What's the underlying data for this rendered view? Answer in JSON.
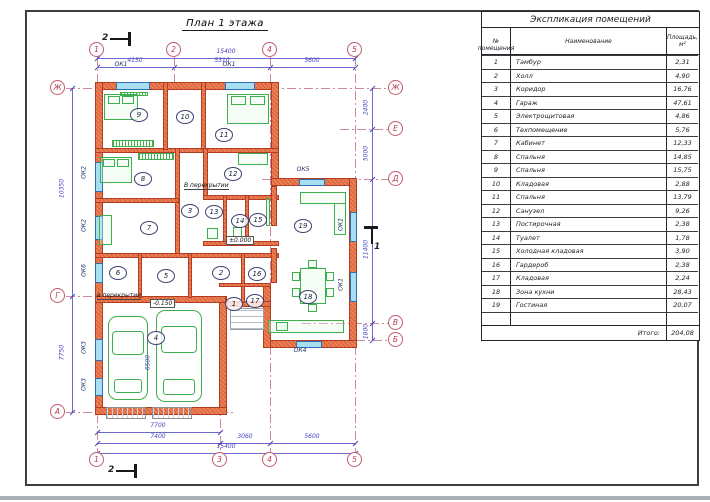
{
  "sheet": {
    "title": "План 1 этажа"
  },
  "table": {
    "title": "Экспликация помещений",
    "col_num": "№ помещения",
    "col_name": "Наименование",
    "col_area_1": "Площадь,",
    "col_area_2": "м²",
    "rows": [
      {
        "n": "1",
        "name": "Тамбур",
        "area": "2,31"
      },
      {
        "n": "2",
        "name": "Холл",
        "area": "4,90"
      },
      {
        "n": "3",
        "name": "Коридор",
        "area": "16,76"
      },
      {
        "n": "4",
        "name": "Гараж",
        "area": "47,61"
      },
      {
        "n": "5",
        "name": "Электрощитовая",
        "area": "4,86"
      },
      {
        "n": "6",
        "name": "Техпомещение",
        "area": "5,76"
      },
      {
        "n": "7",
        "name": "Кабинет",
        "area": "12,33"
      },
      {
        "n": "8",
        "name": "Спальня",
        "area": "14,85"
      },
      {
        "n": "9",
        "name": "Спальня",
        "area": "15,75"
      },
      {
        "n": "10",
        "name": "Кладовая",
        "area": "2,88"
      },
      {
        "n": "11",
        "name": "Спальня",
        "area": "13,79"
      },
      {
        "n": "12",
        "name": "Санузел",
        "area": "9,26"
      },
      {
        "n": "13",
        "name": "Постирочная",
        "area": "2,38"
      },
      {
        "n": "14",
        "name": "Туалет",
        "area": "1,78"
      },
      {
        "n": "15",
        "name": "Холодная кладовая",
        "area": "3,90"
      },
      {
        "n": "16",
        "name": "Гардероб",
        "area": "2,38"
      },
      {
        "n": "17",
        "name": "Кладовая",
        "area": "2,24"
      },
      {
        "n": "18",
        "name": "Зона кухни",
        "area": "28,43"
      },
      {
        "n": "19",
        "name": "Гостиная",
        "area": "20,07"
      }
    ],
    "total_label": "Итого:",
    "total_value": "204,08"
  },
  "plan": {
    "colors": {
      "wall": "#ee7f52",
      "wall_edge": "#b23c24",
      "win": "#a8dff0",
      "win_edge": "#2f6fb5",
      "furn": "#3fae4e",
      "dim": "#4a43c0",
      "grid": "#c4738c",
      "bub": "#c25a70"
    },
    "walls_ext": [
      {
        "x": 95,
        "y": 82,
        "w": 184,
        "h": 8
      },
      {
        "x": 95,
        "y": 82,
        "w": 8,
        "h": 333
      },
      {
        "x": 271,
        "y": 82,
        "w": 8,
        "h": 104
      },
      {
        "x": 271,
        "y": 178,
        "w": 86,
        "h": 8
      },
      {
        "x": 349,
        "y": 178,
        "w": 8,
        "h": 170
      },
      {
        "x": 263,
        "y": 340,
        "w": 94,
        "h": 8
      },
      {
        "x": 263,
        "y": 283,
        "w": 8,
        "h": 65
      },
      {
        "x": 227,
        "y": 301,
        "w": 44,
        "h": 6
      },
      {
        "x": 219,
        "y": 296,
        "w": 8,
        "h": 119
      },
      {
        "x": 95,
        "y": 296,
        "w": 131,
        "h": 7
      },
      {
        "x": 95,
        "y": 407,
        "w": 132,
        "h": 8
      }
    ],
    "walls_int": [
      {
        "x": 95,
        "y": 148,
        "w": 184,
        "h": 5
      },
      {
        "x": 163,
        "y": 82,
        "w": 5,
        "h": 68
      },
      {
        "x": 201,
        "y": 82,
        "w": 5,
        "h": 68
      },
      {
        "x": 175,
        "y": 148,
        "w": 5,
        "h": 110
      },
      {
        "x": 203,
        "y": 148,
        "w": 5,
        "h": 52
      },
      {
        "x": 203,
        "y": 195,
        "w": 76,
        "h": 5
      },
      {
        "x": 223,
        "y": 195,
        "w": 4,
        "h": 50
      },
      {
        "x": 245,
        "y": 195,
        "w": 4,
        "h": 50
      },
      {
        "x": 95,
        "y": 198,
        "w": 84,
        "h": 5
      },
      {
        "x": 203,
        "y": 241,
        "w": 76,
        "h": 5
      },
      {
        "x": 95,
        "y": 253,
        "w": 184,
        "h": 5
      },
      {
        "x": 138,
        "y": 253,
        "w": 4,
        "h": 45
      },
      {
        "x": 188,
        "y": 253,
        "w": 4,
        "h": 45
      },
      {
        "x": 241,
        "y": 253,
        "w": 4,
        "h": 50
      },
      {
        "x": 219,
        "y": 283,
        "w": 52,
        "h": 4
      },
      {
        "x": 271,
        "y": 186,
        "w": 6,
        "h": 40
      },
      {
        "x": 271,
        "y": 248,
        "w": 6,
        "h": 35
      }
    ],
    "windows": [
      {
        "x": 116,
        "y": 82,
        "w": 34,
        "h": 8
      },
      {
        "x": 225,
        "y": 82,
        "w": 30,
        "h": 8
      },
      {
        "x": 95,
        "y": 162,
        "w": 8,
        "h": 30
      },
      {
        "x": 95,
        "y": 216,
        "w": 8,
        "h": 24
      },
      {
        "x": 95,
        "y": 263,
        "w": 8,
        "h": 20
      },
      {
        "x": 95,
        "y": 339,
        "w": 8,
        "h": 22
      },
      {
        "x": 95,
        "y": 378,
        "w": 8,
        "h": 18
      },
      {
        "x": 350,
        "y": 212,
        "w": 7,
        "h": 30
      },
      {
        "x": 350,
        "y": 272,
        "w": 7,
        "h": 30
      },
      {
        "x": 299,
        "y": 179,
        "w": 26,
        "h": 7
      },
      {
        "x": 296,
        "y": 341,
        "w": 26,
        "h": 7
      }
    ],
    "window_labels": [
      {
        "t": "ОК1",
        "x": 121,
        "y": 64
      },
      {
        "t": "ОК1",
        "x": 229,
        "y": 64
      },
      {
        "t": "ОК5",
        "x": 303,
        "y": 169
      },
      {
        "t": "ОК4",
        "x": 300,
        "y": 350
      },
      {
        "t": "ОК2",
        "x": 84,
        "y": 172,
        "rot": true
      },
      {
        "t": "ОК2",
        "x": 84,
        "y": 225,
        "rot": true
      },
      {
        "t": "ОК6",
        "x": 84,
        "y": 270,
        "rot": true
      },
      {
        "t": "ОК3",
        "x": 84,
        "y": 347,
        "rot": true
      },
      {
        "t": "ОК3",
        "x": 84,
        "y": 384,
        "rot": true
      },
      {
        "t": "ОК1",
        "x": 341,
        "y": 224,
        "rot": true
      },
      {
        "t": "ОК1",
        "x": 341,
        "y": 284,
        "rot": true
      }
    ],
    "furniture": [
      {
        "name": "bed",
        "kind": "bed",
        "x": 104,
        "y": 94,
        "w": 34,
        "h": 26
      },
      {
        "name": "radiator",
        "kind": "hatch",
        "x": 120,
        "y": 92,
        "w": 28,
        "h": 4
      },
      {
        "name": "wardrobe",
        "kind": "hatch",
        "x": 112,
        "y": 140,
        "w": 42,
        "h": 7
      },
      {
        "name": "bed",
        "kind": "bed",
        "x": 227,
        "y": 94,
        "w": 42,
        "h": 30
      },
      {
        "name": "bed",
        "kind": "bed",
        "x": 100,
        "y": 157,
        "w": 32,
        "h": 26
      },
      {
        "name": "wardrobe",
        "kind": "hatch",
        "x": 138,
        "y": 153,
        "w": 36,
        "h": 7
      },
      {
        "name": "desk",
        "kind": "rect",
        "x": 99,
        "y": 215,
        "w": 13,
        "h": 30
      },
      {
        "name": "washing-machine",
        "kind": "rect",
        "x": 207,
        "y": 228,
        "w": 11,
        "h": 11
      },
      {
        "name": "toilet",
        "kind": "rect",
        "x": 233,
        "y": 227,
        "w": 9,
        "h": 12
      },
      {
        "name": "bathtub",
        "kind": "rect",
        "x": 238,
        "y": 153,
        "w": 30,
        "h": 12
      },
      {
        "name": "tv",
        "kind": "rect",
        "x": 266,
        "y": 198,
        "w": 4,
        "h": 28
      },
      {
        "name": "sofa",
        "kind": "rect",
        "x": 300,
        "y": 192,
        "w": 46,
        "h": 12
      },
      {
        "name": "sofa",
        "kind": "rect",
        "x": 334,
        "y": 203,
        "w": 12,
        "h": 32
      },
      {
        "name": "dining-table",
        "kind": "rect",
        "x": 300,
        "y": 268,
        "w": 26,
        "h": 36
      },
      {
        "name": "chair",
        "kind": "rect",
        "x": 292,
        "y": 272,
        "w": 8,
        "h": 9
      },
      {
        "name": "chair",
        "kind": "rect",
        "x": 292,
        "y": 288,
        "w": 8,
        "h": 9
      },
      {
        "name": "chair",
        "kind": "rect",
        "x": 326,
        "y": 272,
        "w": 8,
        "h": 9
      },
      {
        "name": "chair",
        "kind": "rect",
        "x": 326,
        "y": 288,
        "w": 8,
        "h": 9
      },
      {
        "name": "chair",
        "kind": "rect",
        "x": 308,
        "y": 260,
        "w": 9,
        "h": 8
      },
      {
        "name": "chair",
        "kind": "rect",
        "x": 308,
        "y": 304,
        "w": 9,
        "h": 8
      },
      {
        "name": "kitchen-counter",
        "kind": "rect",
        "x": 268,
        "y": 320,
        "w": 76,
        "h": 13
      },
      {
        "name": "sink",
        "kind": "rect",
        "x": 276,
        "y": 322,
        "w": 12,
        "h": 9
      },
      {
        "name": "car",
        "kind": "car",
        "x": 108,
        "y": 316,
        "w": 40,
        "h": 84
      },
      {
        "name": "car",
        "kind": "car",
        "x": 156,
        "y": 310,
        "w": 46,
        "h": 92
      },
      {
        "name": "porch-steps",
        "kind": "steps",
        "x": 230,
        "y": 308,
        "w": 34,
        "h": 22
      },
      {
        "name": "garage-door",
        "kind": "gdoor",
        "x": 106,
        "y": 407,
        "w": 40,
        "h": 12
      },
      {
        "name": "garage-door",
        "kind": "gdoor",
        "x": 152,
        "y": 407,
        "w": 40,
        "h": 12
      }
    ],
    "grid_v": [
      {
        "x": 97,
        "y1": 57,
        "y2": 453
      },
      {
        "x": 174,
        "y1": 57,
        "y2": 85
      },
      {
        "x": 220,
        "y1": 300,
        "y2": 453
      },
      {
        "x": 270,
        "y1": 57,
        "y2": 453
      },
      {
        "x": 355,
        "y1": 57,
        "y2": 453
      }
    ],
    "grid_h": [
      {
        "y": 88,
        "x1": 66,
        "x2": 389
      },
      {
        "y": 129,
        "x1": 340,
        "x2": 389
      },
      {
        "y": 179,
        "x1": 262,
        "x2": 389
      },
      {
        "y": 296,
        "x1": 66,
        "x2": 96
      },
      {
        "y": 323,
        "x1": 302,
        "x2": 389
      },
      {
        "y": 340,
        "x1": 305,
        "x2": 389
      },
      {
        "y": 412,
        "x1": 66,
        "x2": 235
      }
    ],
    "bubbles": [
      {
        "t": "1",
        "x": 97,
        "y": 50
      },
      {
        "t": "2",
        "x": 174,
        "y": 50
      },
      {
        "t": "4",
        "x": 270,
        "y": 50
      },
      {
        "t": "5",
        "x": 355,
        "y": 50
      },
      {
        "t": "1",
        "x": 97,
        "y": 460
      },
      {
        "t": "3",
        "x": 220,
        "y": 460
      },
      {
        "t": "4",
        "x": 270,
        "y": 460
      },
      {
        "t": "5",
        "x": 355,
        "y": 460
      },
      {
        "t": "Ж",
        "x": 58,
        "y": 88
      },
      {
        "t": "Г",
        "x": 58,
        "y": 296
      },
      {
        "t": "А",
        "x": 58,
        "y": 412
      },
      {
        "t": "Ж",
        "x": 396,
        "y": 88
      },
      {
        "t": "Е",
        "x": 396,
        "y": 129
      },
      {
        "t": "Д",
        "x": 396,
        "y": 179
      },
      {
        "t": "В",
        "x": 396,
        "y": 323
      },
      {
        "t": "Б",
        "x": 396,
        "y": 340
      }
    ],
    "dim_lines_h": [
      {
        "x1": 97,
        "x2": 355,
        "y": 58
      },
      {
        "x1": 97,
        "x2": 355,
        "y": 67
      },
      {
        "x1": 97,
        "x2": 220,
        "y": 432
      },
      {
        "x1": 97,
        "x2": 355,
        "y": 443
      },
      {
        "x1": 97,
        "x2": 355,
        "y": 453
      }
    ],
    "dim_lines_v": [
      {
        "x": 72,
        "y1": 88,
        "y2": 412
      },
      {
        "x": 372,
        "y1": 88,
        "y2": 340
      }
    ],
    "ticks": [
      {
        "x": 97,
        "y": 58
      },
      {
        "x": 355,
        "y": 58
      },
      {
        "x": 97,
        "y": 67
      },
      {
        "x": 174,
        "y": 67
      },
      {
        "x": 270,
        "y": 67
      },
      {
        "x": 355,
        "y": 67
      },
      {
        "x": 97,
        "y": 432
      },
      {
        "x": 220,
        "y": 432
      },
      {
        "x": 97,
        "y": 443
      },
      {
        "x": 220,
        "y": 443
      },
      {
        "x": 270,
        "y": 443
      },
      {
        "x": 355,
        "y": 443
      },
      {
        "x": 97,
        "y": 453
      },
      {
        "x": 355,
        "y": 453
      },
      {
        "x": 72,
        "y": 88
      },
      {
        "x": 72,
        "y": 296
      },
      {
        "x": 72,
        "y": 412
      },
      {
        "x": 372,
        "y": 88
      },
      {
        "x": 372,
        "y": 129
      },
      {
        "x": 372,
        "y": 179
      },
      {
        "x": 372,
        "y": 323
      },
      {
        "x": 372,
        "y": 340
      }
    ],
    "dim_labels": [
      {
        "t": "15400",
        "x": 226,
        "y": 51
      },
      {
        "t": "4150",
        "x": 135,
        "y": 60
      },
      {
        "t": "5310",
        "x": 222,
        "y": 60
      },
      {
        "t": "5600",
        "x": 312,
        "y": 60
      },
      {
        "t": "7700",
        "x": 158,
        "y": 425
      },
      {
        "t": "7400",
        "x": 158,
        "y": 436
      },
      {
        "t": "3060",
        "x": 245,
        "y": 436
      },
      {
        "t": "5600",
        "x": 312,
        "y": 436
      },
      {
        "t": "15400",
        "x": 226,
        "y": 446
      },
      {
        "t": "10350",
        "x": 62,
        "y": 188,
        "rot": true
      },
      {
        "t": "7750",
        "x": 62,
        "y": 352,
        "rot": true
      },
      {
        "t": "2400",
        "x": 366,
        "y": 107,
        "rot": true
      },
      {
        "t": "5000",
        "x": 366,
        "y": 153,
        "rot": true
      },
      {
        "t": "11400",
        "x": 366,
        "y": 249,
        "rot": true
      },
      {
        "t": "1800",
        "x": 366,
        "y": 331,
        "rot": true
      },
      {
        "t": "6900",
        "x": 168,
        "y": 306
      },
      {
        "t": "6500",
        "x": 148,
        "y": 362,
        "rot": true
      }
    ],
    "rooms": [
      {
        "n": "1",
        "x": 233,
        "y": 303
      },
      {
        "n": "2",
        "x": 220,
        "y": 272
      },
      {
        "n": "3",
        "x": 189,
        "y": 210
      },
      {
        "n": "4",
        "x": 155,
        "y": 337
      },
      {
        "n": "5",
        "x": 165,
        "y": 275
      },
      {
        "n": "6",
        "x": 117,
        "y": 272
      },
      {
        "n": "7",
        "x": 148,
        "y": 227
      },
      {
        "n": "8",
        "x": 142,
        "y": 178
      },
      {
        "n": "9",
        "x": 138,
        "y": 114
      },
      {
        "n": "10",
        "x": 184,
        "y": 116
      },
      {
        "n": "11",
        "x": 223,
        "y": 134
      },
      {
        "n": "12",
        "x": 232,
        "y": 173
      },
      {
        "n": "13",
        "x": 213,
        "y": 211
      },
      {
        "n": "14",
        "x": 239,
        "y": 220
      },
      {
        "n": "15",
        "x": 257,
        "y": 219
      },
      {
        "n": "16",
        "x": 256,
        "y": 273
      },
      {
        "n": "17",
        "x": 254,
        "y": 300
      },
      {
        "n": "18",
        "x": 307,
        "y": 296
      },
      {
        "n": "19",
        "x": 302,
        "y": 225
      }
    ],
    "annotations": [
      {
        "t": "В перекрытии",
        "x": 184,
        "y": 188
      },
      {
        "t": "в перекрытии",
        "x": 97,
        "y": 298
      }
    ],
    "elevations": [
      {
        "t": "-0.150",
        "x": 150,
        "y": 303
      },
      {
        "t": "±0.000",
        "x": 226,
        "y": 240
      }
    ],
    "sections": [
      {
        "t": "2",
        "x": 110,
        "y": 32,
        "kind": "h"
      },
      {
        "t": "2",
        "x": 116,
        "y": 464,
        "kind": "h"
      },
      {
        "t": "1",
        "x": 371,
        "y": 226,
        "kind": "v"
      }
    ]
  }
}
